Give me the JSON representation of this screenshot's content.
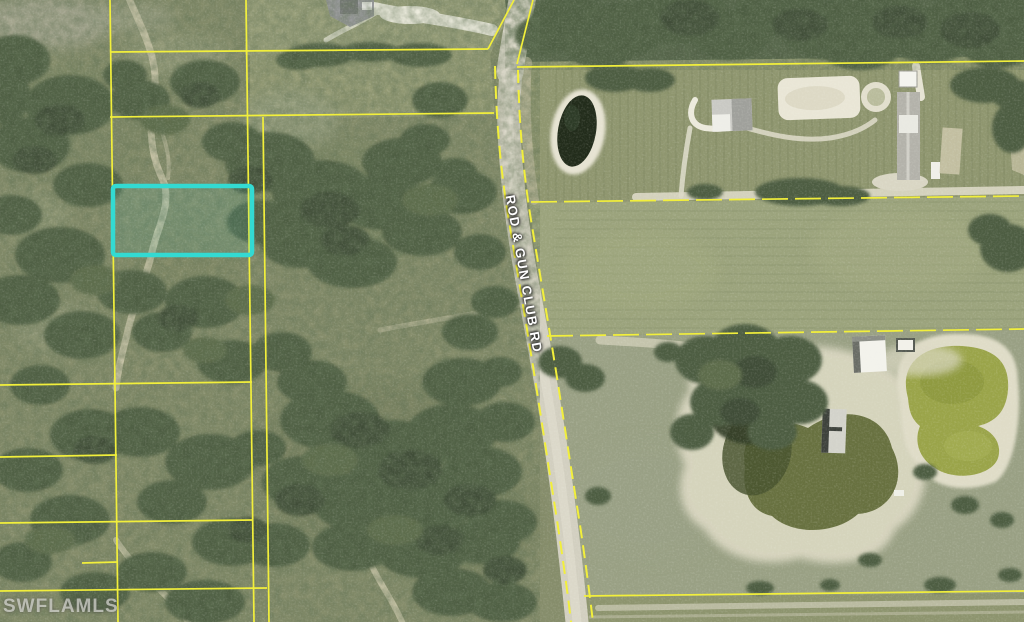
{
  "map": {
    "type": "aerial-parcel-map",
    "road_label": "ROD & GUN CLUB RD",
    "watermark": "SWFLAMLS",
    "colors": {
      "parcel_line": "#f2ef3b",
      "highlight": "#33dad2",
      "road_surface": "#d2cfc0"
    },
    "highlighted_parcel": {
      "x": 113,
      "y": 186,
      "width": 139,
      "height": 69
    }
  }
}
